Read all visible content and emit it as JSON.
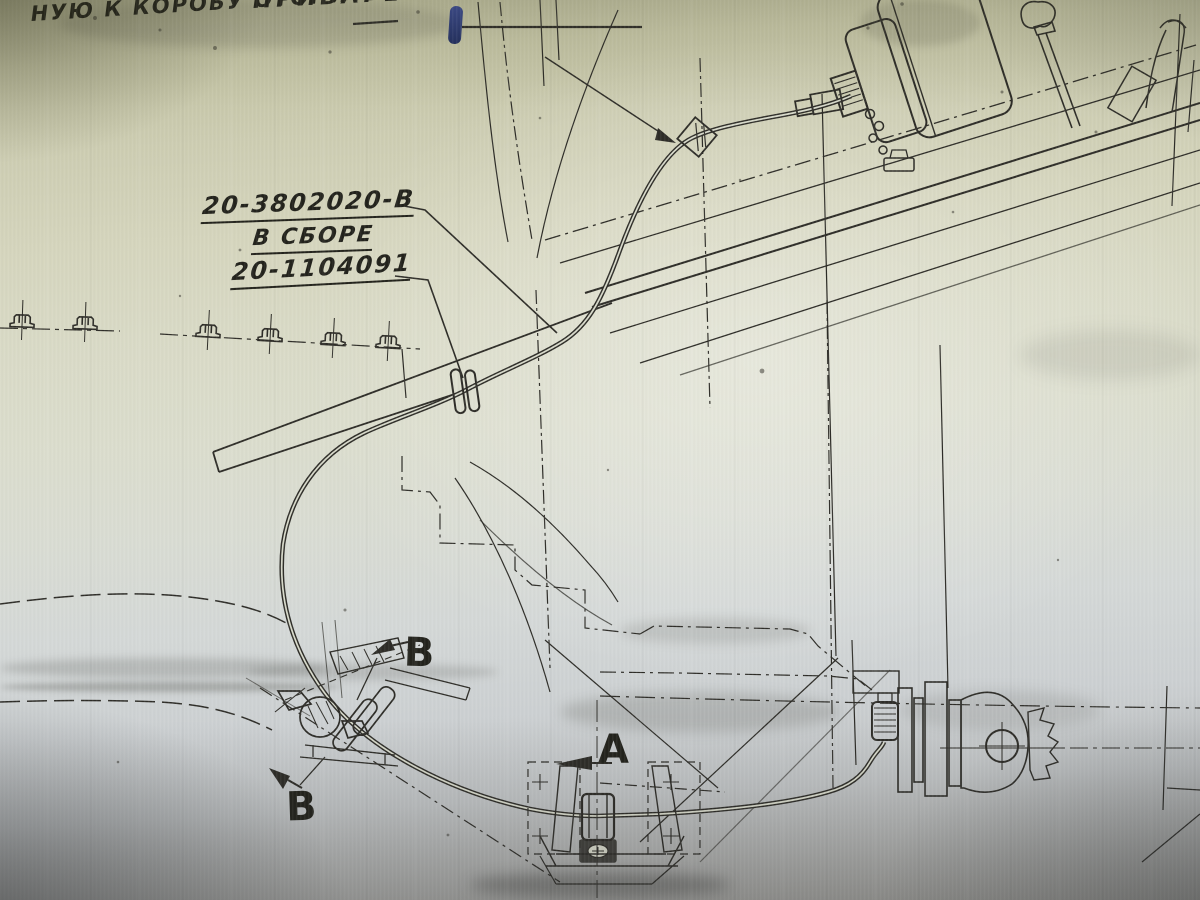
{
  "annotations": {
    "note_line1": "ПРИВАРЕН-",
    "note_line2": "НУЮ К КОРОБУ ОТОПИТЕЛЯ."
  },
  "part_labels": [
    {
      "number": "20-3802020-В",
      "suffix": "В СБОРЕ"
    },
    {
      "number": "20-1104091"
    }
  ],
  "view_markers": [
    {
      "label": "В"
    },
    {
      "label": "В"
    },
    {
      "label": "А"
    }
  ],
  "colors": {
    "paper_top_olive": "#c9c9ac",
    "paper_center": "#dadcca",
    "paper_bottom_gray": "#9b9a95",
    "ink": "#2e2d28",
    "blue_ink_mark": "#2c3d86"
  }
}
